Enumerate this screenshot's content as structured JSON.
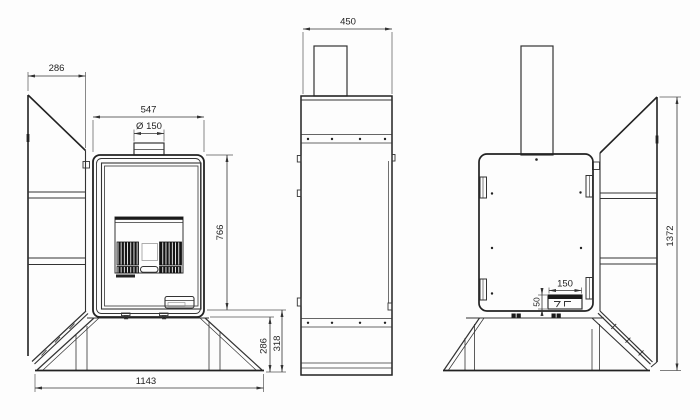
{
  "drawing": {
    "type": "technical-drawing",
    "description": "Three orthographic views (front with open side wing, side, back) of a stove with pedestal base",
    "colors": {
      "line": "#333333",
      "dark_fill": "#1a1a1a",
      "background": "#fdfdfd"
    },
    "dims": {
      "wing_width": "286",
      "body_width": "547",
      "flue_diameter": "Ø 150",
      "body_height": "766",
      "pedestal_height_inner": "286",
      "pedestal_height_outer": "318",
      "overall_width": "1143",
      "depth": "450",
      "socket_cutout_width": "150",
      "socket_cutout_height": "50",
      "overall_height": "1372"
    }
  }
}
